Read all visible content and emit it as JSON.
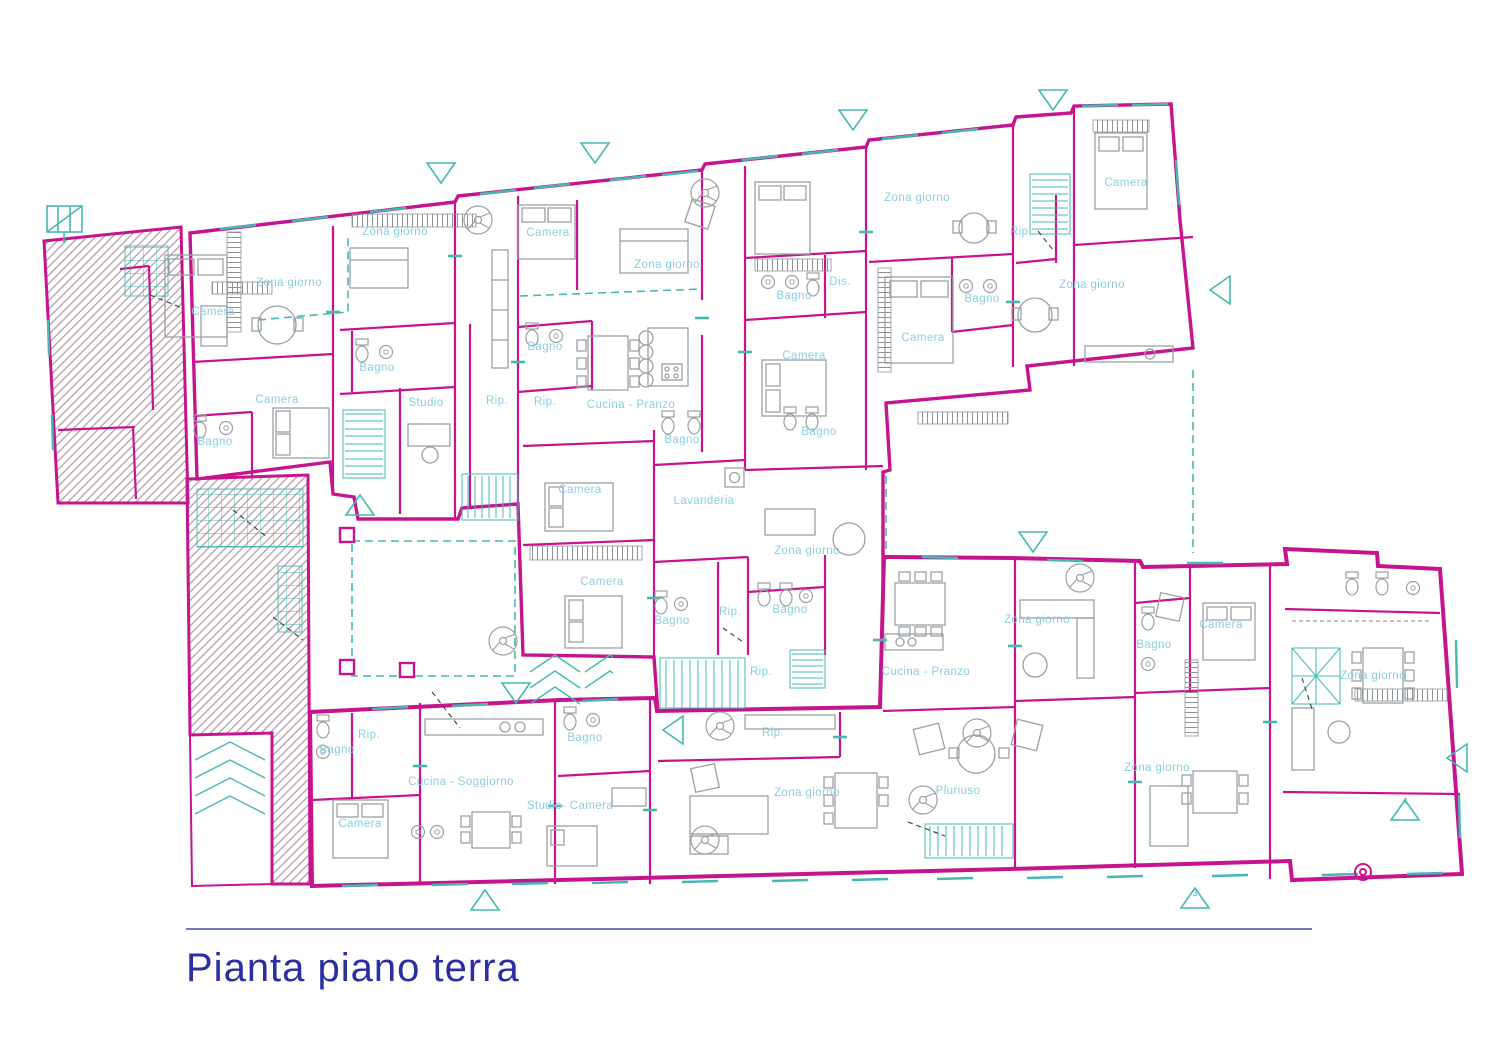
{
  "title": {
    "text": "Pianta piano terra"
  },
  "colors": {
    "wall_magenta": "#c6148e",
    "annotation_cyan": "#45b8b2",
    "room_label_blue": "#8bcddf",
    "furniture_gray": "#9ba0a4",
    "hatch_mauve": "#b096a1",
    "title_blue": "#2b2fa3"
  },
  "plan": {
    "room_labels": [
      {
        "text": "Camera",
        "x": 213,
        "y": 315
      },
      {
        "text": "Zona giorno",
        "x": 289,
        "y": 286
      },
      {
        "text": "Camera",
        "x": 277,
        "y": 403
      },
      {
        "text": "Bagno",
        "x": 215,
        "y": 445
      },
      {
        "text": "Bagno",
        "x": 377,
        "y": 371
      },
      {
        "text": "Studio",
        "x": 426,
        "y": 406
      },
      {
        "text": "Rip.",
        "x": 497,
        "y": 404
      },
      {
        "text": "Zona giorno",
        "x": 395,
        "y": 235
      },
      {
        "text": "Camera",
        "x": 548,
        "y": 236
      },
      {
        "text": "Bagno",
        "x": 545,
        "y": 350
      },
      {
        "text": "Rip.",
        "x": 545,
        "y": 405
      },
      {
        "text": "Zona giorno",
        "x": 667,
        "y": 268
      },
      {
        "text": "Cucina - Pranzo",
        "x": 631,
        "y": 408
      },
      {
        "text": "Bagno",
        "x": 682,
        "y": 443
      },
      {
        "text": "Bagno",
        "x": 794,
        "y": 299
      },
      {
        "text": "Dis.",
        "x": 840,
        "y": 285
      },
      {
        "text": "Camera",
        "x": 804,
        "y": 359
      },
      {
        "text": "Bagno",
        "x": 819,
        "y": 435
      },
      {
        "text": "Zona giorno",
        "x": 917,
        "y": 201
      },
      {
        "text": "Camera",
        "x": 923,
        "y": 341
      },
      {
        "text": "Bagno",
        "x": 982,
        "y": 302
      },
      {
        "text": "Rip.",
        "x": 1021,
        "y": 235
      },
      {
        "text": "Camera",
        "x": 1126,
        "y": 186
      },
      {
        "text": "Zona giorno",
        "x": 1092,
        "y": 288
      },
      {
        "text": "Camera",
        "x": 580,
        "y": 493
      },
      {
        "text": "Lavanderia",
        "x": 704,
        "y": 504
      },
      {
        "text": "Zona giorno",
        "x": 807,
        "y": 554
      },
      {
        "text": "Camera",
        "x": 602,
        "y": 585
      },
      {
        "text": "Bagno",
        "x": 672,
        "y": 624
      },
      {
        "text": "Rip.",
        "x": 730,
        "y": 615
      },
      {
        "text": "Bagno",
        "x": 790,
        "y": 613
      },
      {
        "text": "Rip.",
        "x": 761,
        "y": 675
      },
      {
        "text": "Bagno",
        "x": 337,
        "y": 753
      },
      {
        "text": "Rip.",
        "x": 369,
        "y": 738
      },
      {
        "text": "Cucina - Soggiorno",
        "x": 461,
        "y": 785
      },
      {
        "text": "Camera",
        "x": 360,
        "y": 827
      },
      {
        "text": "Bagno",
        "x": 585,
        "y": 741
      },
      {
        "text": "Studio- Camera",
        "x": 570,
        "y": 809
      },
      {
        "text": "Rip.",
        "x": 773,
        "y": 736
      },
      {
        "text": "Zona giorno",
        "x": 807,
        "y": 796
      },
      {
        "text": "Cucina - Pranzo",
        "x": 926,
        "y": 675
      },
      {
        "text": "Zona giorno",
        "x": 1037,
        "y": 623
      },
      {
        "text": "Bagno",
        "x": 1154,
        "y": 648
      },
      {
        "text": "Camera",
        "x": 1221,
        "y": 628
      },
      {
        "text": "Pluriuso",
        "x": 958,
        "y": 794
      },
      {
        "text": "Zona giorno",
        "x": 1157,
        "y": 771
      },
      {
        "text": "Zona giorno",
        "x": 1373,
        "y": 679
      }
    ],
    "marker_numbers": [
      {
        "text": "3",
        "x": 1195,
        "y": 896
      },
      {
        "text": "4",
        "x": 1405,
        "y": 804
      }
    ]
  }
}
